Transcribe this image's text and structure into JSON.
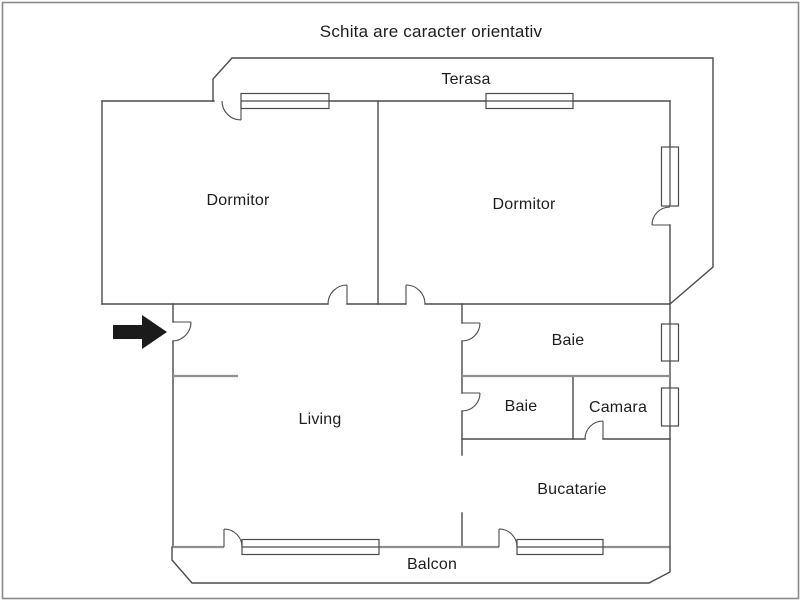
{
  "title": "Schita are caracter orientativ",
  "rooms": {
    "terasa": {
      "label": "Terasa"
    },
    "dormitor_left": {
      "label": "Dormitor"
    },
    "dormitor_right": {
      "label": "Dormitor"
    },
    "baie_top": {
      "label": "Baie"
    },
    "baie_bottom": {
      "label": "Baie"
    },
    "camara": {
      "label": "Camara"
    },
    "living": {
      "label": "Living"
    },
    "bucatarie": {
      "label": "Bucatarie"
    },
    "balcon": {
      "label": "Balcon"
    }
  },
  "icons": {
    "entrance_arrow": "right-arrow"
  },
  "colors": {
    "wall": "#4b4b4b",
    "wall_light": "#8f8f8f",
    "text": "#1d1d1d",
    "arrow": "#1b1b1b",
    "border": "#8a8a8a",
    "background": "#ffffff"
  }
}
